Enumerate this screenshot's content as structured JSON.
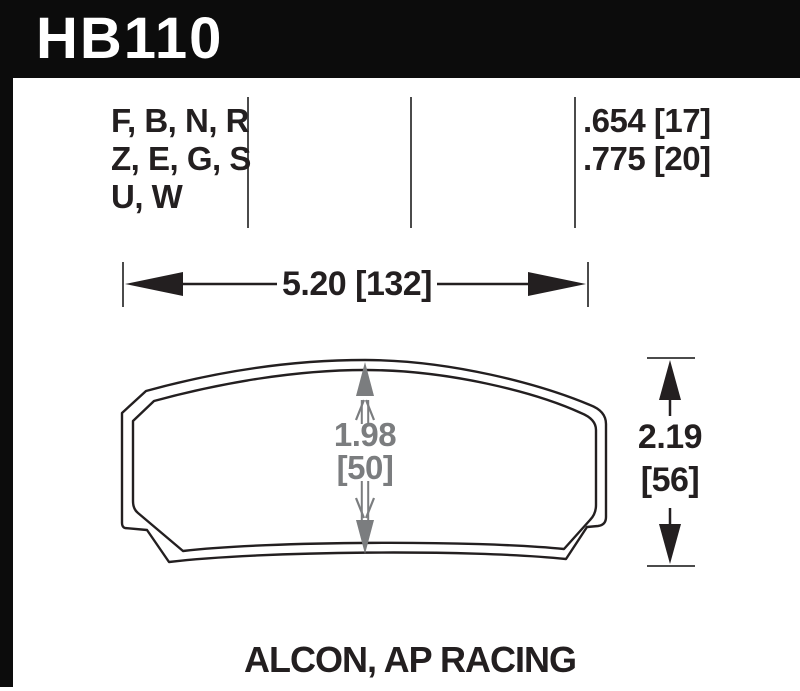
{
  "part": {
    "number": "HB110"
  },
  "spec": {
    "compounds": [
      "F, B, N, R",
      "Z, E, G, S",
      "U, W"
    ],
    "thickness": [
      ".654 [17]",
      ".775 [20]"
    ]
  },
  "dims": {
    "width": "5.20 [132]",
    "center": [
      "1.98",
      "[50]"
    ],
    "overall": [
      "2.19",
      "[56]"
    ]
  },
  "footer": {
    "applications": "ALCON, AP RACING"
  },
  "colors": {
    "bar_black": "#0c0c0c",
    "ink_black": "#231f20",
    "dim_gray": "#7b7d7f",
    "line_gray": "#4b4b4b"
  }
}
